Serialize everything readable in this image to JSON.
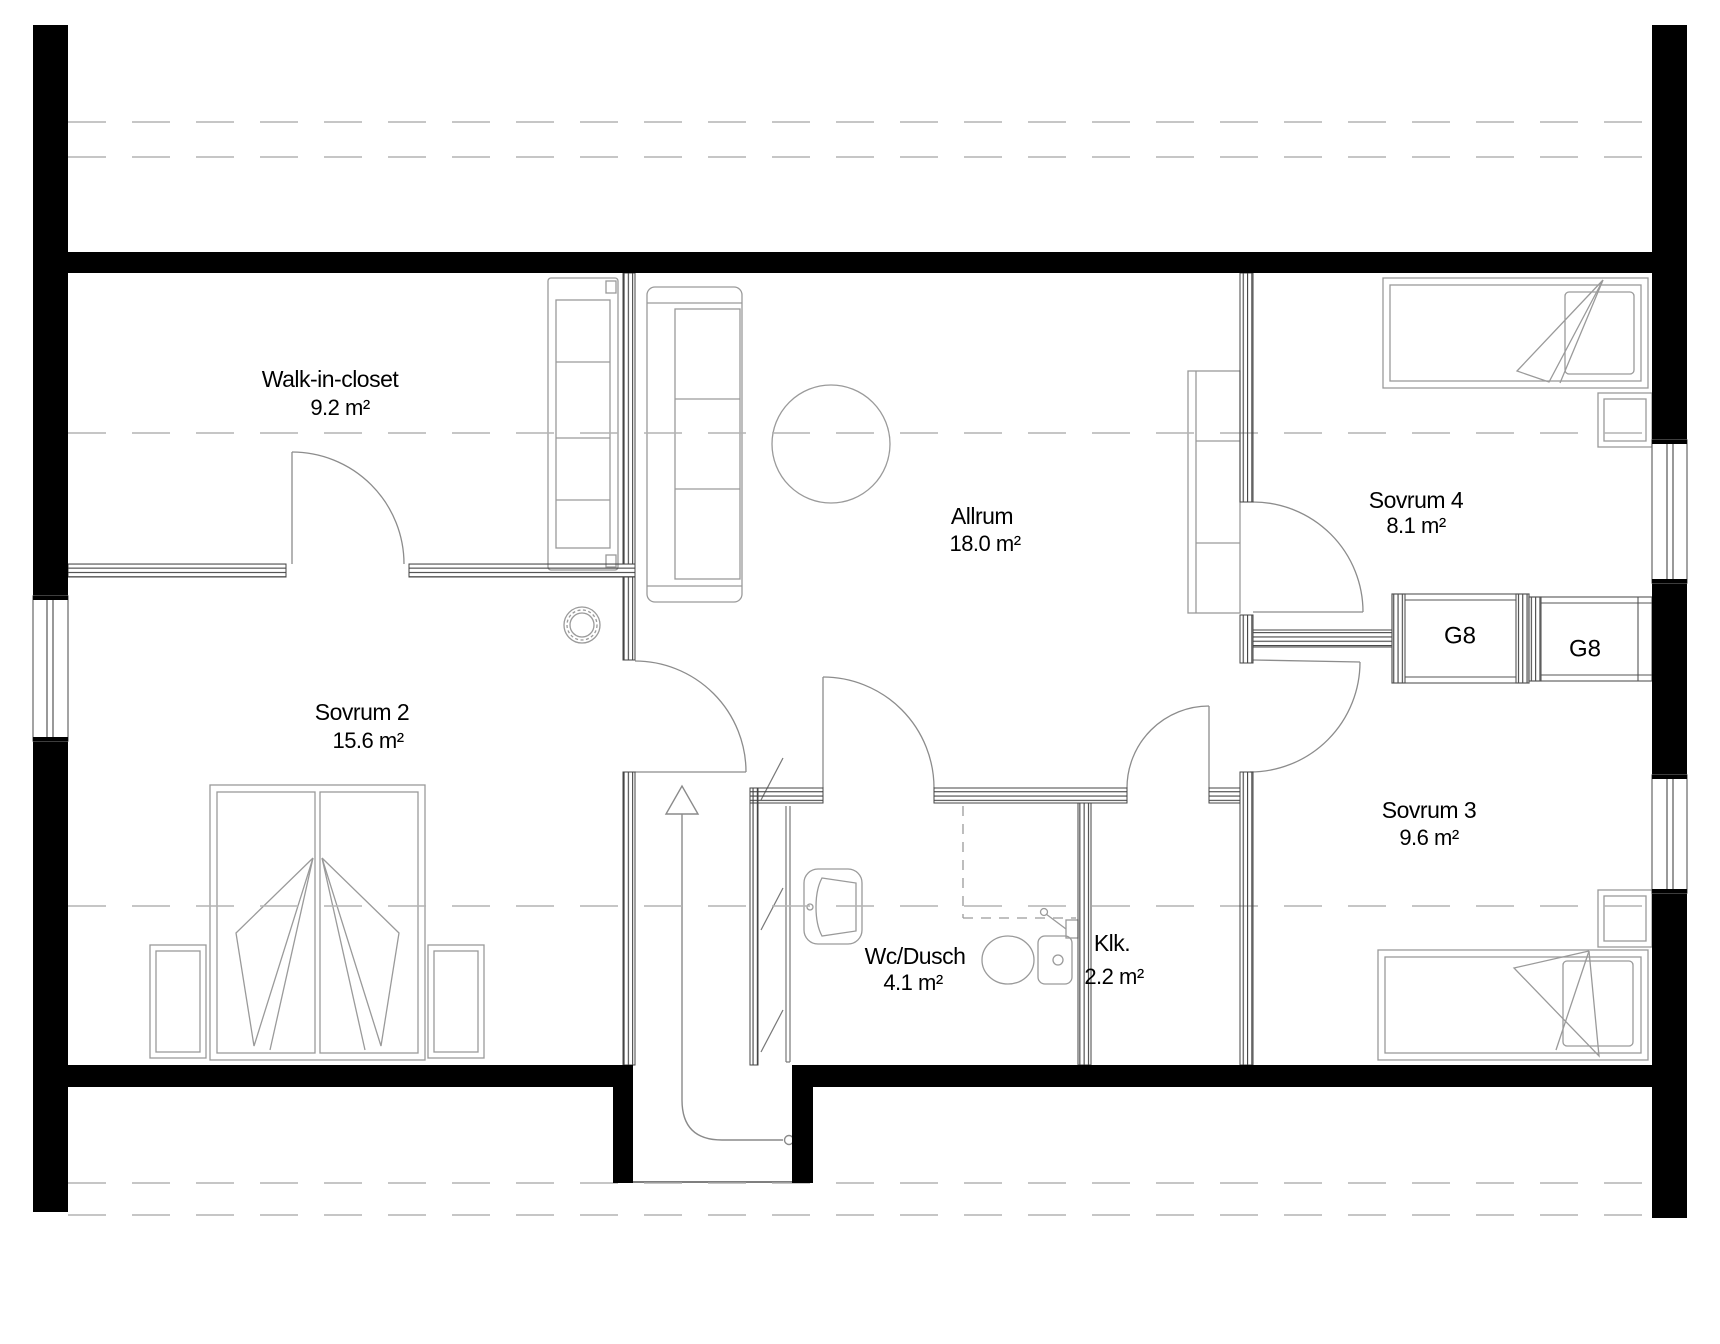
{
  "plan": {
    "rooms": [
      {
        "id": "walk-in-closet",
        "name": "Walk-in-closet",
        "area": "9.2 m²"
      },
      {
        "id": "sovrum-2",
        "name": "Sovrum 2",
        "area": "15.6 m²"
      },
      {
        "id": "allrum",
        "name": "Allrum",
        "area": "18.0 m²"
      },
      {
        "id": "sovrum-4",
        "name": "Sovrum 4",
        "area": "8.1 m²"
      },
      {
        "id": "sovrum-3",
        "name": "Sovrum 3",
        "area": "9.6 m²"
      },
      {
        "id": "wc-dusch",
        "name": "Wc/Dusch",
        "area": "4.1 m²"
      },
      {
        "id": "klk",
        "name": "Klk.",
        "area": "2.2 m²"
      }
    ],
    "wardrobes": [
      {
        "label": "G8"
      },
      {
        "label": "G8"
      }
    ],
    "colors": {
      "exterior_wall": "#000000",
      "partition_line": "#444444",
      "furniture_line": "#999999",
      "dashed_roof_line": "#b4b4b4",
      "background": "#ffffff",
      "text": "#000000"
    }
  }
}
